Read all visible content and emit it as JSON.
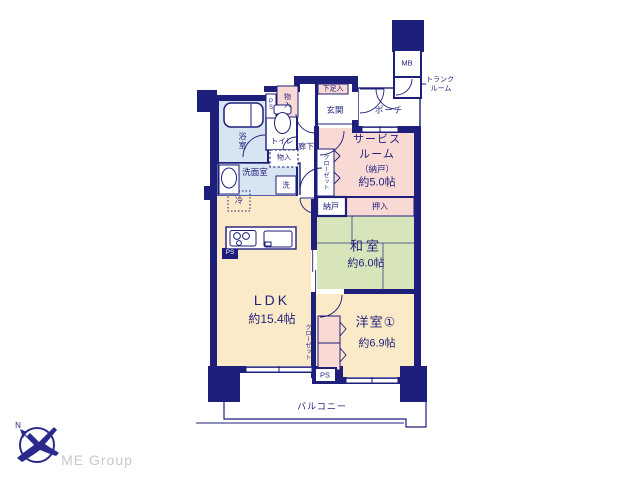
{
  "plan": {
    "rooms": {
      "ldk": {
        "name": "LDK",
        "size": "約15.4帖"
      },
      "washitsu": {
        "name": "和室",
        "size": "約6.0帖"
      },
      "youshitsu1": {
        "name": "洋室①",
        "size": "約6.9帖"
      },
      "service": {
        "line1": "サービス",
        "line2": "ルーム",
        "line3": "（納戸）",
        "line4": "約5.0帖"
      }
    },
    "labels": {
      "balcony": "バルコニー",
      "genkan": "玄関",
      "porch": "ポーチ",
      "shoe_box": "下足入",
      "storage": "物入",
      "toilet": "トイレ",
      "bath": "浴室",
      "washroom": "洗面室",
      "washer": "洗",
      "fridge": "冷",
      "hallway": "廊下",
      "closet": "クローゼット",
      "nando": "納戸",
      "oshiire": "押入",
      "mb": "MB",
      "trunk_line1": "トランク",
      "trunk_line2": "ルーム",
      "ps": "PS",
      "north": "N"
    },
    "colors": {
      "wall": "#1e1e7b",
      "text": "#23237d",
      "room_cream": "#faeac7",
      "room_green": "#d8e5ba",
      "room_pink": "#f8d9d4",
      "room_blue": "#d7e4f2",
      "logo_gray": "#c8c8c8"
    }
  },
  "branding": {
    "company": "ME Group"
  }
}
